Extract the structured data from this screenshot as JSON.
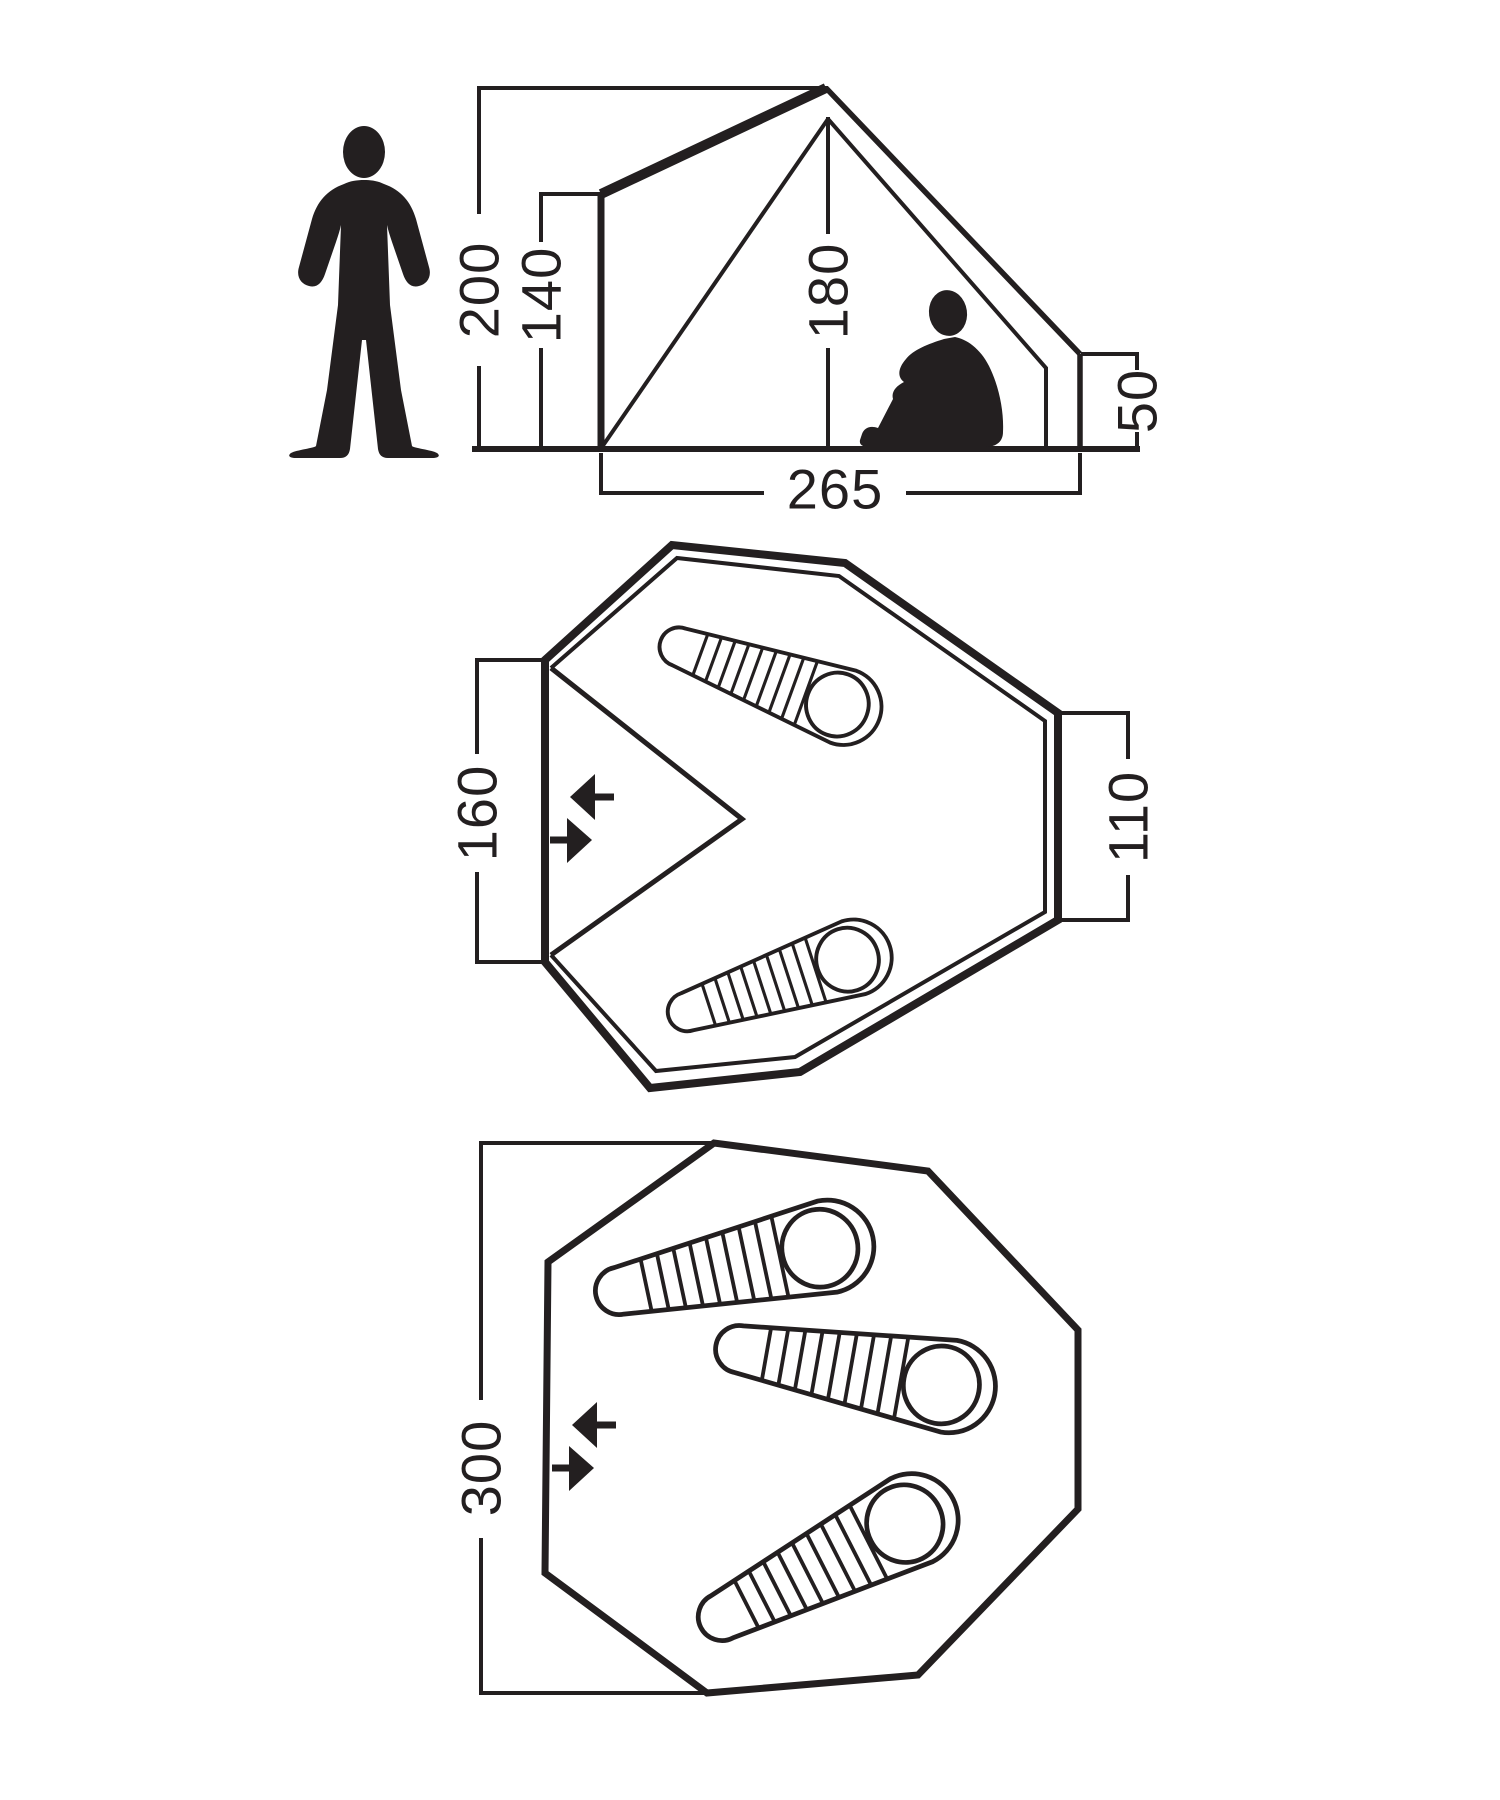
{
  "colors": {
    "ink": "#231f20",
    "background": "#ffffff"
  },
  "side_view": {
    "peak_height": "200",
    "front_wall_height": "140",
    "inner_height": "180",
    "rear_wall_height": "50",
    "floor_depth": "265"
  },
  "floorplan_two_person": {
    "door_side_width": "160",
    "rear_side_width": "110",
    "sleeping_bags": 2
  },
  "floorplan_three_person": {
    "floor_length": "300",
    "sleeping_bags": 3
  }
}
